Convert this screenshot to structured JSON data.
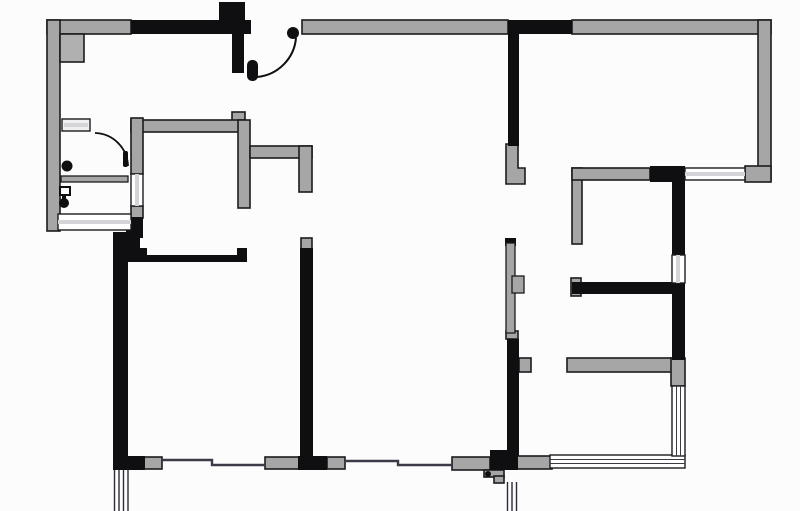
{
  "plan": {
    "type": "apartment-floor-plan",
    "visible_text": ""
  },
  "colors": {
    "background": "#fcfcfd",
    "wall_fill": "#a6a6a6",
    "wall_fill_light": "#b0b0b0",
    "wall_dark": "#0f0f12",
    "outline": "#1c1c1f",
    "thin_line": "#3e3947",
    "window_fill": "#ffffff",
    "window_stripe": "#d3d3d8",
    "rail_line": "#2e2a36",
    "jamb_fill": "#efefef"
  },
  "icons": {
    "entry_door_swing": "quarter-arc",
    "entry_door_hinge": "filled-circle",
    "entry_door_leaf": "rounded-capsule",
    "bathroom_door_swing": "quarter-arc",
    "bathroom_drain": "filled-circle",
    "bathroom_plumbing": "hook-and-dot-glyph",
    "sliding_door": "narrow-bar-with-tab",
    "floor_stop": "small-circle"
  }
}
